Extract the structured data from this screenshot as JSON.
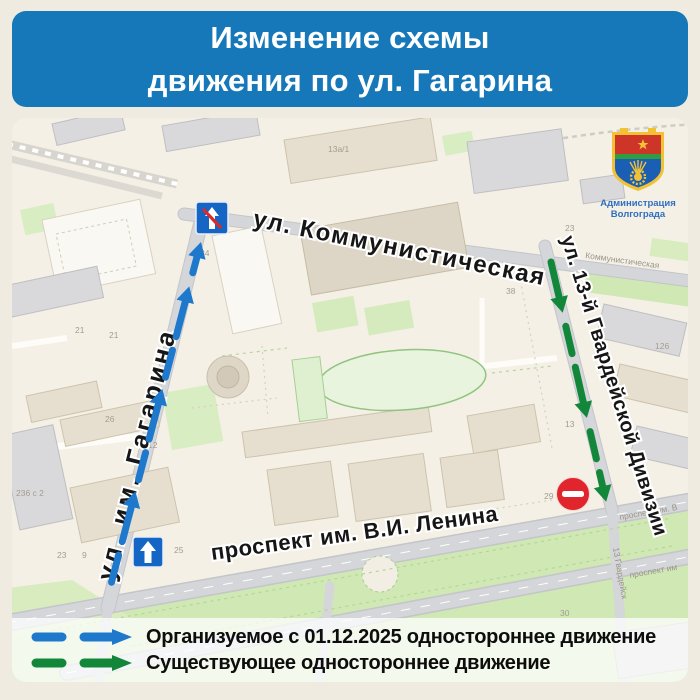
{
  "title": {
    "line1": "Изменение схемы",
    "line2": "движения по ул. Гагарина"
  },
  "logo": {
    "org_line1": "Администрация",
    "org_line2": "Волгограда"
  },
  "map": {
    "street_labels": {
      "kommunisticheskaya": "ул. Коммунистическая",
      "gagarina": "ул. им. Гагарина",
      "gvardeyskoy": "ул. 13-й Гвардейской Дивизии",
      "lenina": "проспект им. В.И. Ленина"
    },
    "minor_labels": {
      "kommunisticheskaya_small": "Коммунистическая",
      "prospekt_small_1": "проспект им. В",
      "prospekt_small_2": "проспект им",
      "gvardeyskoy_small": "13 Гвардейск"
    },
    "house_numbers": [
      "13а/1",
      "34",
      "21",
      "21",
      "26",
      "236 с 2",
      "23",
      "9",
      "12",
      "25",
      "38",
      "126",
      "13",
      "29",
      "30",
      "23"
    ],
    "signs": {
      "oneway_end": "end-of-one-way-road-sign",
      "oneway": "one-way-road-sign",
      "no_entry": "no-entry-sign"
    }
  },
  "legend": {
    "new_route": "Организуемое с 01.12.2025 одностороннее движение",
    "existing_route": "Существующее одностороннее движение"
  },
  "colors": {
    "header_blue": "#1678b8",
    "new_route_blue": "#1e78cc",
    "existing_route_green": "#12873a"
  }
}
